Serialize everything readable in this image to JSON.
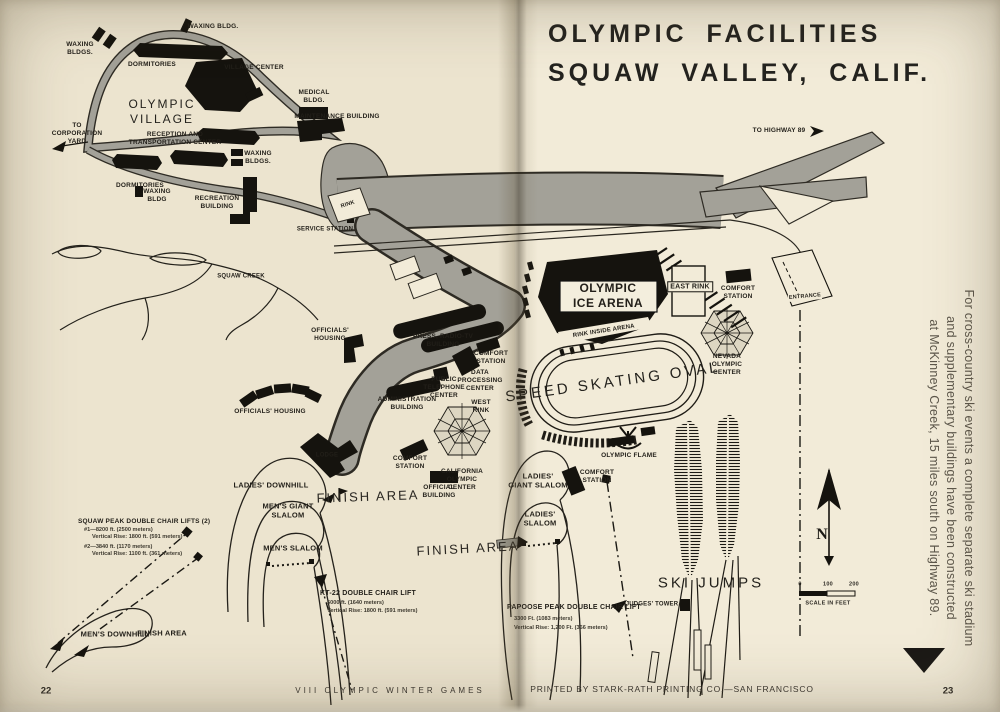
{
  "title": {
    "line1": "OLYMPIC FACILITIES",
    "line2": "SQUAW VALLEY, CALIF."
  },
  "footer": {
    "left_page_number": "22",
    "left_text": "VIII OLYMPIC WINTER GAMES",
    "right_text": "PRINTED BY STARK-RATH PRINTING CO.—SAN FRANCISCO",
    "right_page_number": "23"
  },
  "side_note": {
    "line1": "For cross-country ski events a complete separate ski stadium",
    "line2": "and supplementary buildings have been constructed",
    "line3": "at McKinney Creek, 15 miles south on Highway 89."
  },
  "compass": {
    "north": "N"
  },
  "scale_bar": {
    "t0": "0",
    "t100": "100",
    "t200": "200",
    "caption": "SCALE IN FEET"
  },
  "colors": {
    "paper_left": "#ece4cf",
    "paper_right": "#f2ebd8",
    "ink": "#15130e",
    "road_gray": "#a3a198"
  },
  "labels": {
    "waxing_bldgs_nw": "WAXING\nBLDGS.",
    "waxing_bldg_top": "WAXING  BLDG.",
    "dormitories_top": "DORMITORIES",
    "village_center": "VILLAGE CENTER",
    "olympic_village": "OLYMPIC\nVILLAGE",
    "medical_bldg": "MEDICAL\nBLDG.",
    "maintenance_building": "MAINTENANCE BUILDING",
    "to_corporation_yard": "TO\nCORPORATION\nYARD",
    "reception_center": "RECEPTION AND\nTRANSPORTATION CENTER",
    "waxing_bldgs_mid": "WAXING\nBLDGS.",
    "dormitories_bottom": "DORMITORIES",
    "waxing_bldg_sw": "WAXING\nBLDG",
    "recreation_building": "RECREATION\nBUILDING",
    "rink_small": "RINK",
    "service_station": "SERVICE STATION",
    "squaw_creek": "SQUAW CREEK",
    "officials_housing_upper": "OFFICIALS'\nHOUSING",
    "press_radio_tv": "PRESS, RADIO-TV\nBUILDING",
    "comfort_station_press": "COMFORT\nSTATION",
    "public_telephone_center": "PUBLIC\nTELEPHONE\nCENTER",
    "data_processing_center": "DATA\nPROCESSING\nCENTER",
    "administration_building": "ADMINISTRATION\nBUILDING",
    "west_rink": "WEST\nRINK",
    "officials_housing_lower": "OFFICIALS' HOUSING",
    "lodge": "LODGE",
    "comfort_station_lodge": "COMFORT\nSTATION",
    "california_olympic_center": "CALIFORNIA\nOLYMPIC\nCENTER",
    "official_building": "OFFICIAL\nBUILDING",
    "finish_area_west": "FINISH AREA",
    "ladies_downhill": "LADIES' DOWNHILL",
    "mens_giant_slalom": "MEN'S GIANT\nSLALOM",
    "mens_slalom": "MEN'S SLALOM",
    "squaw_peak_title": "SQUAW PEAK DOUBLE CHAIR LIFTS (2)",
    "squaw_peak_l1": "#1—8200 ft. (2500 meters)",
    "squaw_peak_l2": "Vertical Rise: 1800 ft. (591 meters)",
    "squaw_peak_l3": "#2—3840 ft. (1170 meters)",
    "squaw_peak_l4": "Vertical Rise: 1100 ft. (361 meters)",
    "mens_downhill": "MEN'S DOWNHILL",
    "finish_area_downhill": "FINISH AREA",
    "kt22_title": "KT-22 DOUBLE CHAIR LIFT",
    "kt22_l1": "5000 ft. (1640 meters)",
    "kt22_l2": "Vertical Rise: 1800 ft. (591 meters)",
    "finish_area_center": "FINISH AREA",
    "to_highway_89": "TO HIGHWAY 89",
    "olympic_ice_arena": "OLYMPIC\nICE ARENA",
    "rink_inside_arena": "RINK INSIDE ARENA",
    "east_rink": "EAST RINK",
    "comfort_station_east": "COMFORT\nSTATION",
    "entrance": "ENTRANCE",
    "nevada_olympic_center": "NEVADA\nOLYMPIC\nCENTER",
    "speed_skating_oval": "SPEED SKATING OVAL",
    "olympic_flame": "OLYMPIC FLAME",
    "ladies_giant_slalom": "LADIES'\nGIANT SLALOM",
    "comfort_station_slalom": "COMFORT\nSTATION",
    "ladies_slalom": "LADIES'\nSLALOM",
    "papoose_title": "PAPOOSE PEAK DOUBLE CHAIR LIFT",
    "papoose_l1": "3300 Ft. (1083 meters)",
    "papoose_l2": "Vertical Rise: 1,200 Ft. (366 meters)",
    "judges_tower": "JUDGES' TOWER",
    "ski_jumps": "SKI JUMPS"
  }
}
